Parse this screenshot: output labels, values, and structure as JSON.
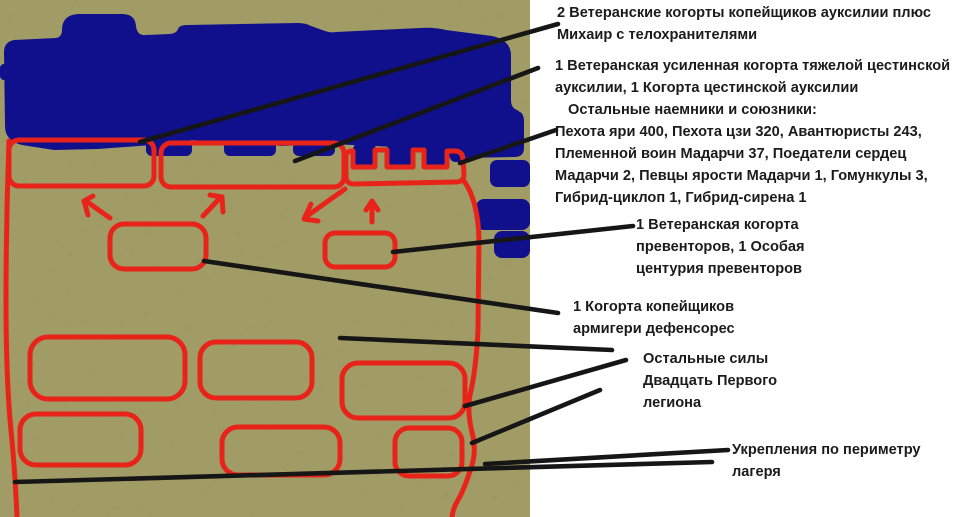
{
  "colors": {
    "background": "#ffffff",
    "terrain": "#9a9458",
    "terrain_mottle": "#6b6636",
    "units": "#10108c",
    "markings": "#e8231a",
    "callout_line": "#161616",
    "text": "#1b1b1b"
  },
  "map": {
    "description_labels": {
      "enemy_unit_mass": "enemy-army-blob",
      "camp_perimeter": "camp-perimeter-outline",
      "deployment_zones": "red-deployment-rectangles"
    }
  },
  "callouts": [
    {
      "id": "veteran-spearmen",
      "lines": [
        "2 Ветеранские когорты копейщиков ауксилии плюс",
        "Михаир с телохранителями"
      ]
    },
    {
      "id": "cestine-auxilia",
      "lines": [
        "1 Ветеранская усиленная когорта тяжелой цестинской",
        "ауксилии, 1 Когорта цестинской ауксилии"
      ]
    },
    {
      "id": "mercenaries-allies",
      "lines": [
        "Остальные наемники и союзники:",
        "Пехота яри 400, Пехота цзи 320, Авантюристы 243,",
        "Племенной воин Мадарчи 37, Поедатели сердец",
        "Мадарчи 2, Певцы ярости Мадарчи 1, Гомункулы 3,",
        "Гибрид-циклоп 1, Гибрид-сирена 1"
      ]
    },
    {
      "id": "preventors",
      "lines": [
        "1 Ветеранская когорта",
        "превенторов, 1 Особая",
        "центурия превенторов"
      ]
    },
    {
      "id": "armigeri-defensores",
      "lines": [
        "1 Когорта копейщиков",
        "армигери дефенсорес"
      ]
    },
    {
      "id": "legion-forces",
      "lines": [
        "Остальные силы",
        "Двадцать Первого",
        "легиона"
      ]
    },
    {
      "id": "fortifications",
      "lines": [
        "Укрепления по периметру",
        "лагеря"
      ]
    }
  ]
}
